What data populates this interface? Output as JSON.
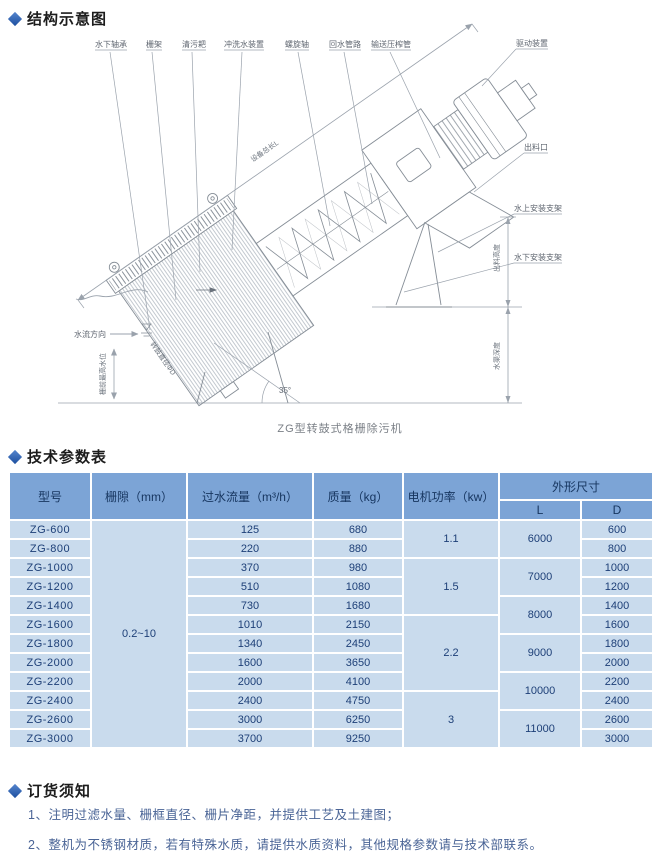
{
  "colors": {
    "accent": "#2a5db3",
    "table_header_bg": "#7ca4d6",
    "table_cell_bg": "#c9dbed",
    "table_text": "#1d3f77",
    "note_text": "#4a6496",
    "drawing_line": "#858d96",
    "dimension_line": "#9aa2ac"
  },
  "sections": {
    "structure_title": "结构示意图",
    "parameters_title": "技术参数表",
    "order_title": "订货须知"
  },
  "diagram": {
    "caption": "ZG型转鼓式格栅除污机",
    "angle": "35°",
    "top_labels": [
      "水下轴承",
      "栅架",
      "清污耙",
      "冲洗水装置",
      "螺旋轴",
      "回水管路",
      "输送压榨管"
    ],
    "labels": {
      "drive": "驱动装置",
      "outlet": "出料口",
      "bracket_above": "水上安装支架",
      "bracket_below": "水下安装支架",
      "total_length": "设备总长L",
      "flow_dir": "水流方向",
      "water_level": "栅前最高水位",
      "discharge_height": "出料高度",
      "channel_depth": "水渠深度",
      "drum_dia": "转鼓直径ΦD"
    }
  },
  "table": {
    "headers": {
      "model": "型号",
      "gap": "栅隙（mm）",
      "flow": "过水流量（m³/h）",
      "weight": "质量（kg）",
      "power": "电机功率（kw）",
      "dims": "外形尺寸",
      "L": "L",
      "D": "D"
    },
    "gap_value": "0.2~10",
    "rows": [
      {
        "model": "ZG-600",
        "flow": "125",
        "weight": "680",
        "power": "1.1",
        "L": "6000",
        "D": "600"
      },
      {
        "model": "ZG-800",
        "flow": "220",
        "weight": "880",
        "D": "800"
      },
      {
        "model": "ZG-1000",
        "flow": "370",
        "weight": "980",
        "power": "1.5",
        "L": "7000",
        "D": "1000"
      },
      {
        "model": "ZG-1200",
        "flow": "510",
        "weight": "1080",
        "D": "1200"
      },
      {
        "model": "ZG-1400",
        "flow": "730",
        "weight": "1680",
        "L": "8000",
        "D": "1400"
      },
      {
        "model": "ZG-1600",
        "flow": "1010",
        "weight": "2150",
        "power": "2.2",
        "D": "1600"
      },
      {
        "model": "ZG-1800",
        "flow": "1340",
        "weight": "2450",
        "L": "9000",
        "D": "1800"
      },
      {
        "model": "ZG-2000",
        "flow": "1600",
        "weight": "3650",
        "D": "2000"
      },
      {
        "model": "ZG-2200",
        "flow": "2000",
        "weight": "4100",
        "L": "10000",
        "D": "2200"
      },
      {
        "model": "ZG-2400",
        "flow": "2400",
        "weight": "4750",
        "power": "3",
        "D": "2400"
      },
      {
        "model": "ZG-2600",
        "flow": "3000",
        "weight": "6250",
        "L": "11000",
        "D": "2600"
      },
      {
        "model": "ZG-3000",
        "flow": "3700",
        "weight": "9250",
        "D": "3000"
      }
    ]
  },
  "notes": {
    "items": [
      "1、注明过滤水量、栅框直径、栅片净距，并提供工艺及土建图；",
      "2、整机为不锈钢材质，若有特殊水质，请提供水质资料，其他规格参数请与技术部联系。"
    ]
  }
}
